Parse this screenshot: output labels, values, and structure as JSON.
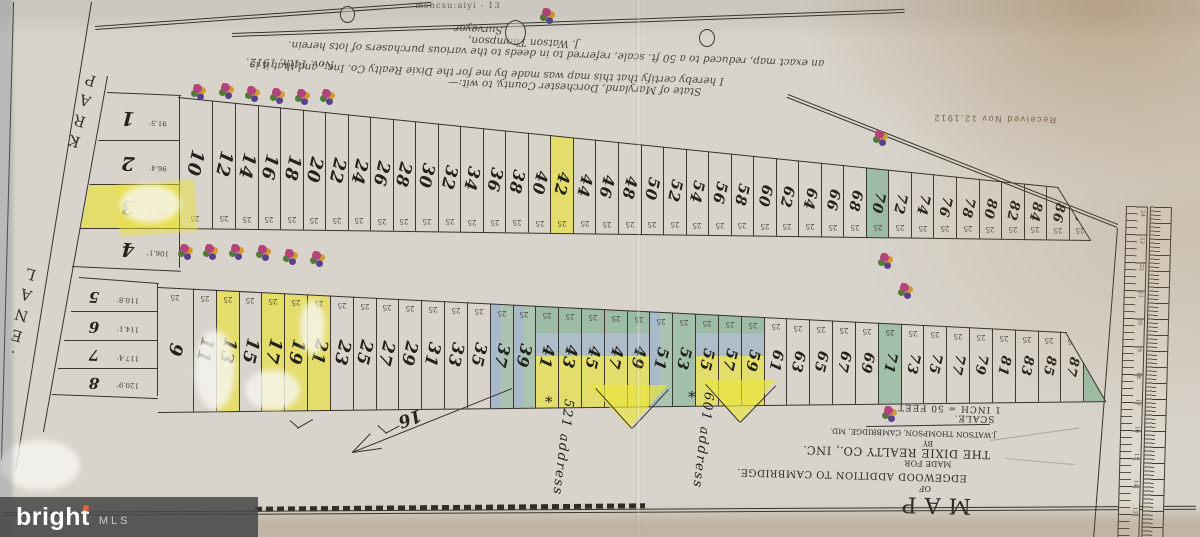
{
  "watermark": {
    "brand": "bright",
    "suffix": "MLS"
  },
  "faint_note": "msncsu:aiyi - 13",
  "stamp": "Received Nov 12.1912",
  "certification": {
    "line1": "State of Maryland, Dorchester County, to wit:—",
    "line2": "I hereby certify that this map was made by me for the Dixie Realty Co. Inc., and that it is",
    "line3": "an exact map, reduced to a 50 ft. scale, referred to in deeds to the various purchasers of lots herein.",
    "date": "Nov. 14th, 1912.",
    "sign1": "J. Watson Thompson,",
    "sign2": "Surveyor."
  },
  "streets": {
    "park": "PARK",
    "lane": "LANE."
  },
  "title_block": {
    "map": "MAP",
    "of": "OF",
    "addition": "EDGEWOOD ADDITION TO CAMBRIDGE.",
    "made_for": "MADE FOR",
    "company": "THE DIXIE REALTY CO., INC.",
    "by": "BY",
    "surveyor": "J.WATSON THOMPSON, CAMBRIDGE, MD.",
    "scale_label": "SCALE.",
    "scale_value": "1 INCH = 50 FEET"
  },
  "annotations": {
    "addr1": "521 address",
    "addr2": "601 address",
    "arrow_label": "16",
    "star": "*"
  },
  "lot_width_label": "25",
  "rows": {
    "top": {
      "lots": [
        {
          "n": "10"
        },
        {
          "n": "12"
        },
        {
          "n": "14"
        },
        {
          "n": "16"
        },
        {
          "n": "18"
        },
        {
          "n": "20"
        },
        {
          "n": "22"
        },
        {
          "n": "24"
        },
        {
          "n": "26"
        },
        {
          "n": "28"
        },
        {
          "n": "30"
        },
        {
          "n": "32"
        },
        {
          "n": "34"
        },
        {
          "n": "36"
        },
        {
          "n": "38"
        },
        {
          "n": "40"
        },
        {
          "n": "42",
          "hl": "y"
        },
        {
          "n": "44"
        },
        {
          "n": "46"
        },
        {
          "n": "48"
        },
        {
          "n": "50"
        },
        {
          "n": "52"
        },
        {
          "n": "54"
        },
        {
          "n": "56"
        },
        {
          "n": "58"
        },
        {
          "n": "60"
        },
        {
          "n": "62"
        },
        {
          "n": "64"
        },
        {
          "n": "66"
        },
        {
          "n": "68"
        },
        {
          "n": "70",
          "hl": "yg"
        },
        {
          "n": "72"
        },
        {
          "n": "74"
        },
        {
          "n": "76"
        },
        {
          "n": "78"
        },
        {
          "n": "80"
        },
        {
          "n": "82"
        },
        {
          "n": "84"
        },
        {
          "n": "86"
        },
        {
          "n": "88"
        }
      ]
    },
    "bottom": {
      "lots": [
        {
          "n": "9"
        },
        {
          "n": "11"
        },
        {
          "n": "13",
          "hl": "y"
        },
        {
          "n": "15"
        },
        {
          "n": "17",
          "hl": "y"
        },
        {
          "n": "19",
          "hl": "y"
        },
        {
          "n": "21",
          "hl": "y"
        },
        {
          "n": "23"
        },
        {
          "n": "25"
        },
        {
          "n": "27"
        },
        {
          "n": "29"
        },
        {
          "n": "31"
        },
        {
          "n": "33"
        },
        {
          "n": "35"
        },
        {
          "n": "37",
          "hl": "b"
        },
        {
          "n": "39",
          "hl": "b"
        },
        {
          "n": "41",
          "hl": "gy"
        },
        {
          "n": "43",
          "hl": "gy"
        },
        {
          "n": "45",
          "hl": "gy"
        },
        {
          "n": "47",
          "hl": "gy"
        },
        {
          "n": "49",
          "hl": "gy"
        },
        {
          "n": "51",
          "hl": "b"
        },
        {
          "n": "53",
          "hl": "g"
        },
        {
          "n": "55",
          "hl": "gy"
        },
        {
          "n": "57",
          "hl": "gy"
        },
        {
          "n": "59",
          "hl": "gy"
        },
        {
          "n": "61"
        },
        {
          "n": "63"
        },
        {
          "n": "65"
        },
        {
          "n": "67"
        },
        {
          "n": "69"
        },
        {
          "n": "71",
          "hl": "g"
        },
        {
          "n": "73"
        },
        {
          "n": "75"
        },
        {
          "n": "77"
        },
        {
          "n": "79"
        },
        {
          "n": "81"
        },
        {
          "n": "83"
        },
        {
          "n": "85"
        },
        {
          "n": "87"
        },
        {
          "n": "89",
          "hl": "yg"
        }
      ]
    }
  },
  "left_blocks": {
    "upper": [
      {
        "n": "1",
        "dim": "91.5'"
      },
      {
        "n": "2",
        "dim": "96.4'"
      },
      {
        "n": "3",
        "dim": "101.4'",
        "hl": "y"
      },
      {
        "n": "4",
        "dim": "106.1'"
      }
    ],
    "lower": [
      {
        "n": "5",
        "dim": "110.8'"
      },
      {
        "n": "6",
        "dim": "114.1'"
      },
      {
        "n": "7",
        "dim": "117.4'"
      },
      {
        "n": "8",
        "dim": "120.9'"
      }
    ]
  },
  "ruler_numbers": [
    "24",
    "23",
    "22",
    "21",
    "20",
    "19",
    "18",
    "17",
    "16",
    "15",
    "14",
    "13"
  ]
}
